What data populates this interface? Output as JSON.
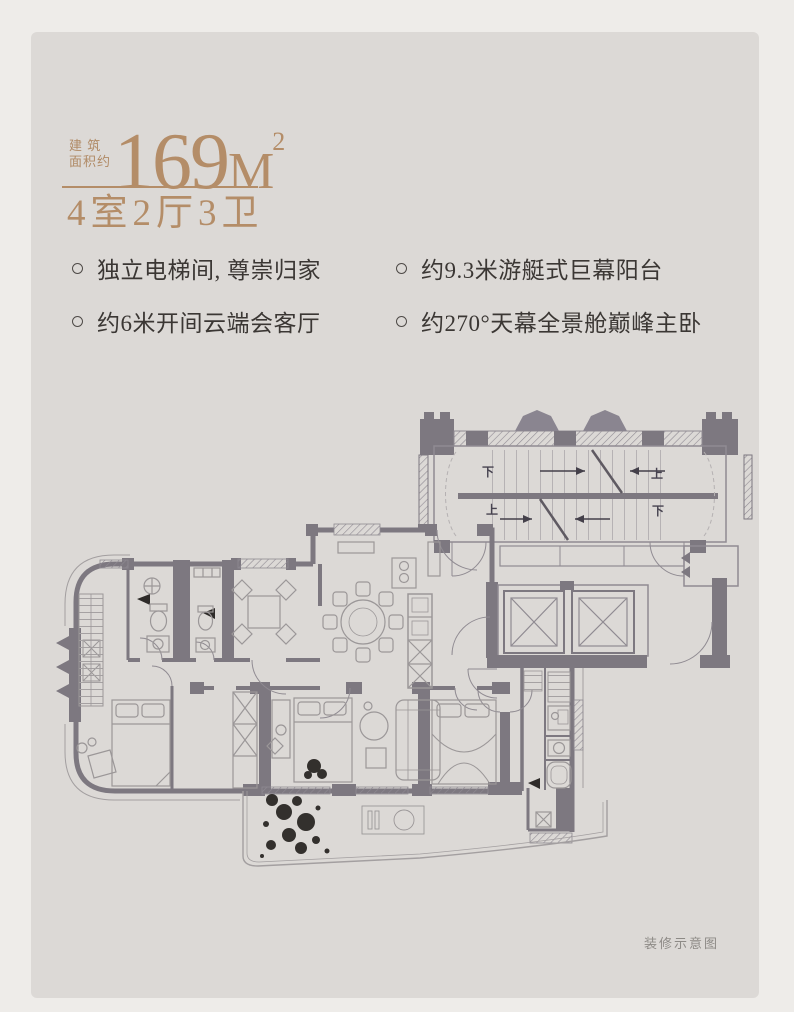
{
  "page": {
    "background": "#eeece9",
    "card_background": "#dcd9d6"
  },
  "header": {
    "area_label_line1": "建 筑",
    "area_label_line2": "面积约",
    "area_value": "169",
    "area_unit": "M",
    "area_sup": "2",
    "layout": "4室2厅3卫",
    "accent_color": "#b48d68"
  },
  "features": {
    "left": [
      "独立电梯间, 尊崇归家",
      "约6米开间云端会客厅"
    ],
    "right": [
      "约9.3米游艇式巨幕阳台",
      "约270°天幕全景舱巅峰主卧"
    ]
  },
  "floorplan": {
    "stair_labels": {
      "top_left": "下",
      "top_right": "上",
      "bottom_left": "上",
      "bottom_right": "下"
    },
    "caption": "装修示意图",
    "wall_color": "#7d7880",
    "furniture_line_color": "#9b9798",
    "text_color": "#3b3734"
  }
}
